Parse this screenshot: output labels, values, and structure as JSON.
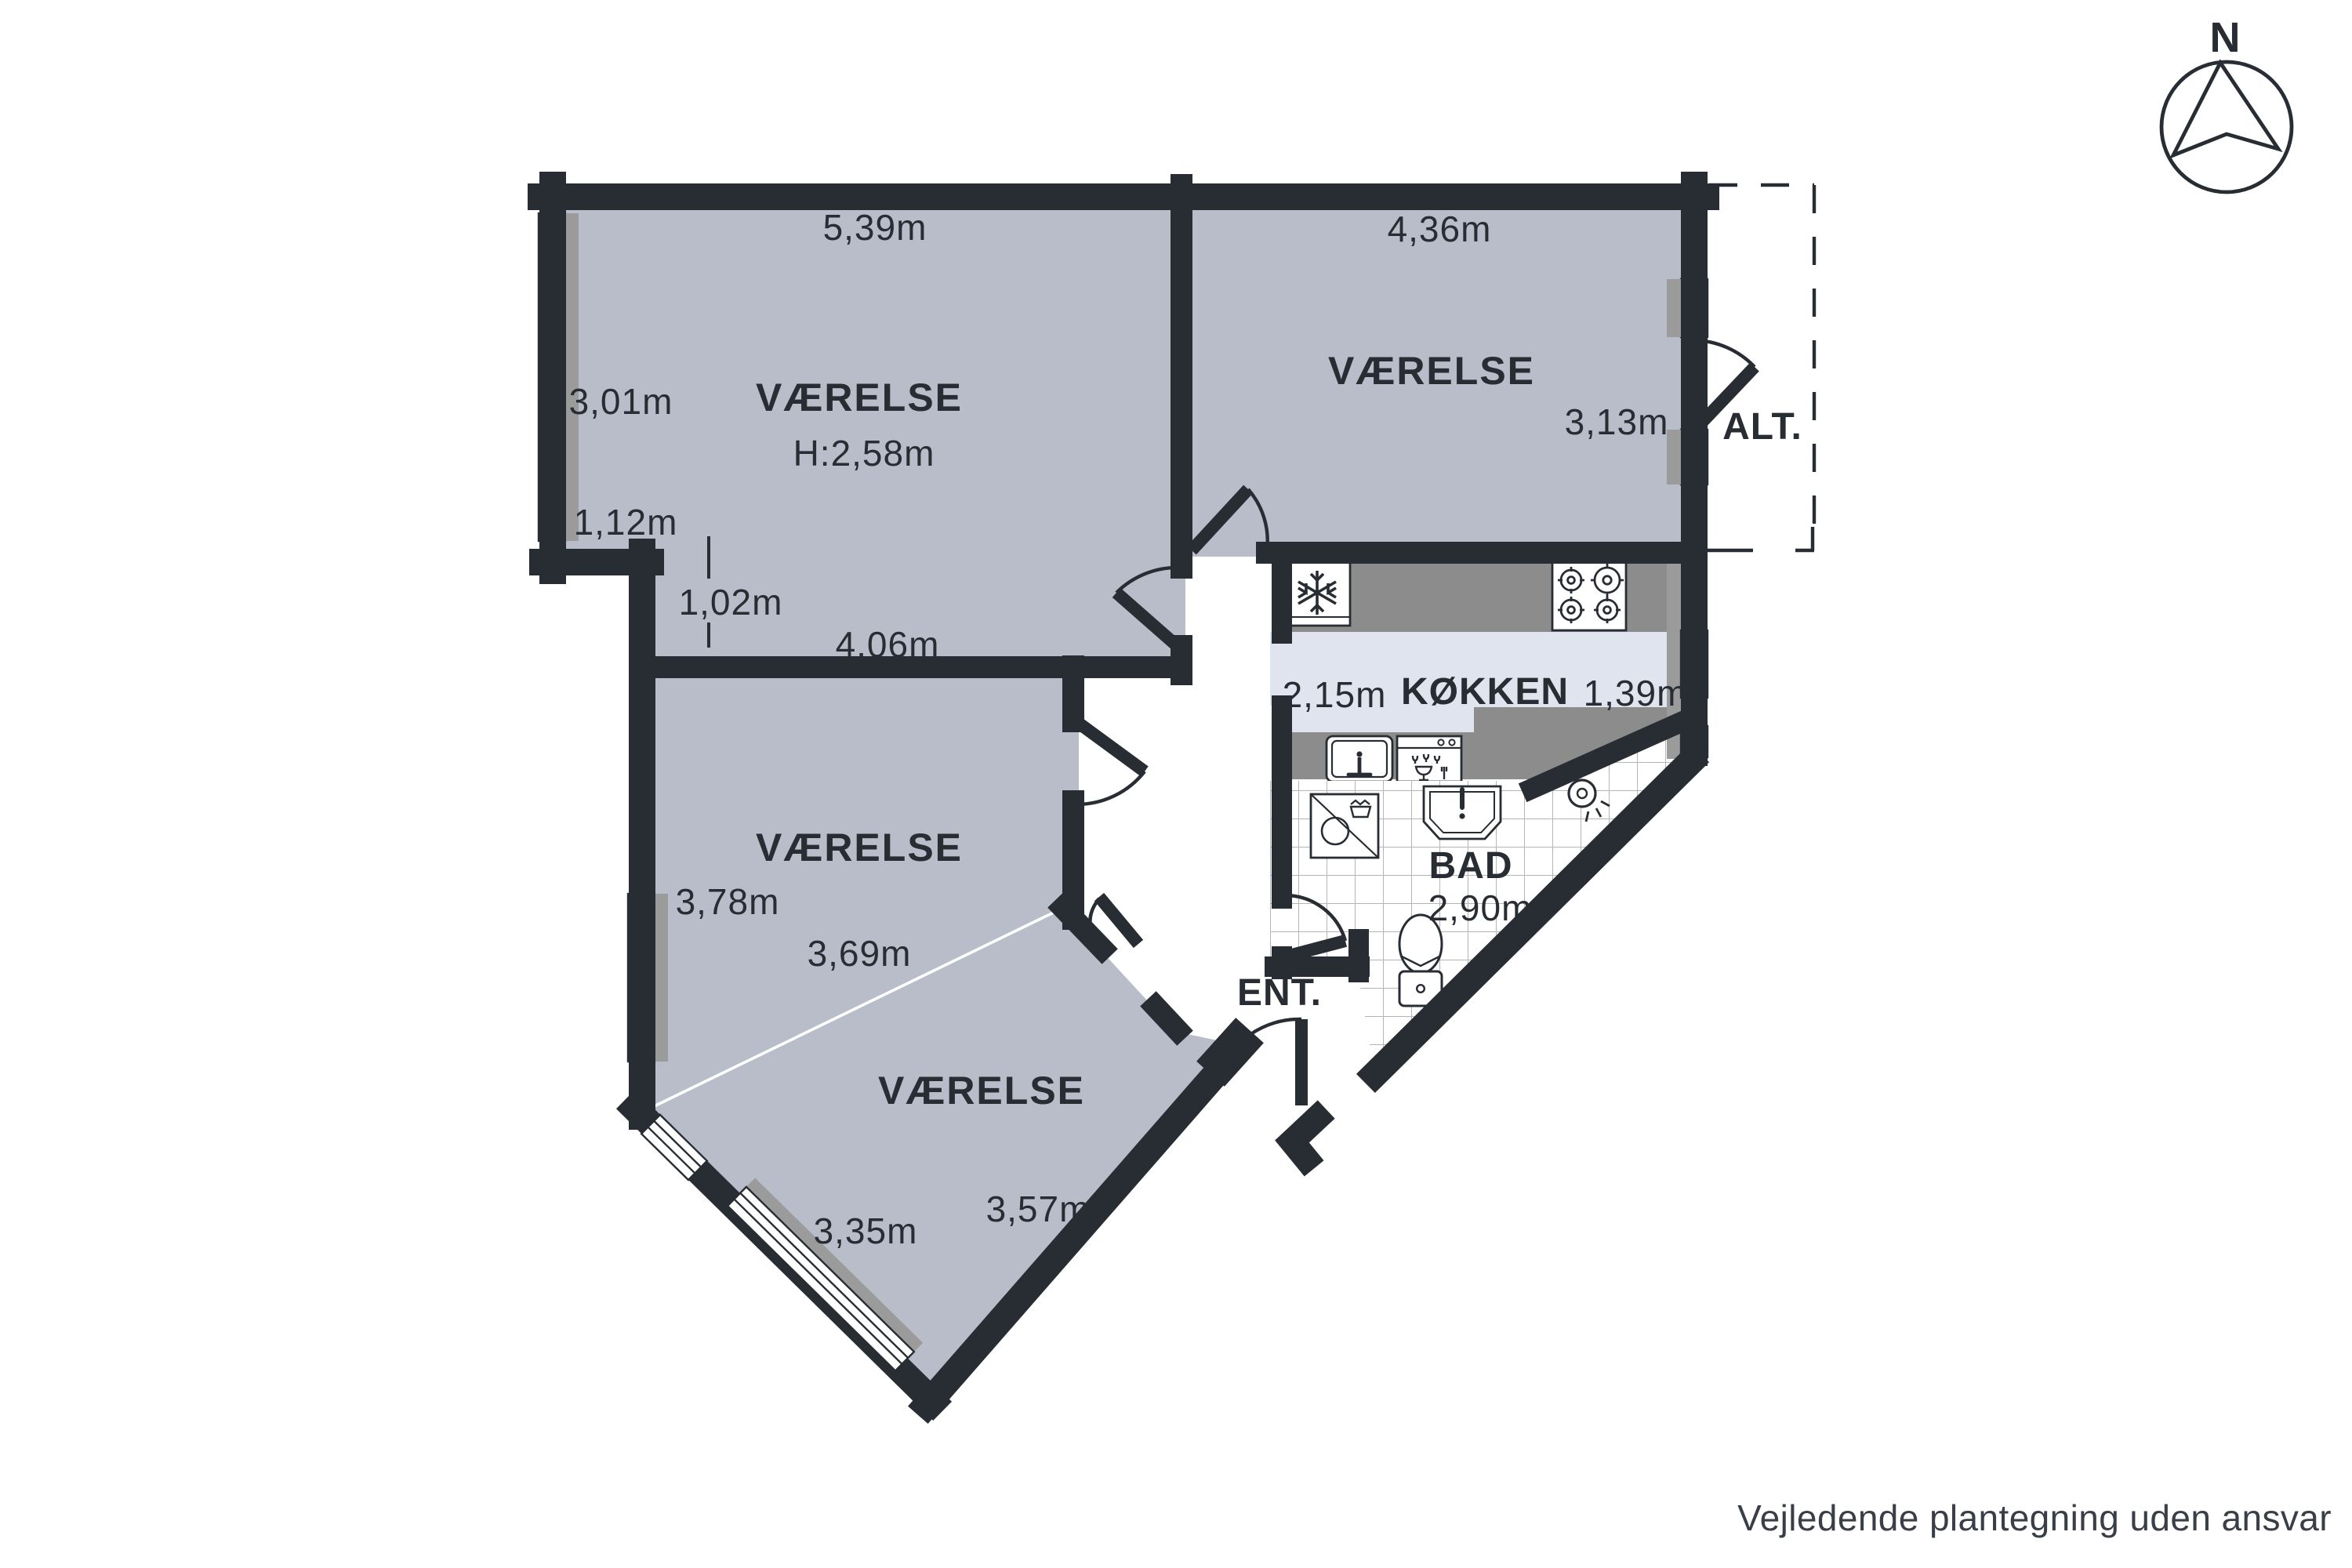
{
  "colors": {
    "wall": "#282d34",
    "room_fill": "#b8bdc9",
    "kitchen_floor": "#dfe4ef",
    "counter": "#8c8c8c",
    "window_sill": "#9b9b9b",
    "tile_line": "#b5b5b5",
    "text": "#282d34"
  },
  "compass": {
    "label": "N"
  },
  "rooms": [
    {
      "id": "room-top-left",
      "label": "VÆRELSE",
      "height_label": "H:2,58m",
      "dim_top": "5,39m",
      "dim_left": "3,01m",
      "dim_step": "1,12m",
      "dim_inner": "1,02m",
      "dim_bottom": "4,06m"
    },
    {
      "id": "room-top-right",
      "label": "VÆRELSE",
      "dim_top": "4,36m",
      "dim_right": "3,13m"
    },
    {
      "id": "room-middle-left",
      "label": "VÆRELSE",
      "dim_left": "3,78m",
      "dim_diagonal": "3,69m"
    },
    {
      "id": "room-bottom",
      "label": "VÆRELSE",
      "dim_right": "3,57m",
      "dim_bottom": "3,35m"
    }
  ],
  "kitchen": {
    "label": "KØKKEN",
    "dim_left": "2,15m",
    "dim_right": "1,39m"
  },
  "bathroom": {
    "label": "BAD",
    "dim": "2,90m"
  },
  "entrance": {
    "label": "ENT."
  },
  "balcony": {
    "label": "ALT."
  },
  "footer": {
    "disclaimer": "Vejledende plantegning uden ansvar"
  }
}
